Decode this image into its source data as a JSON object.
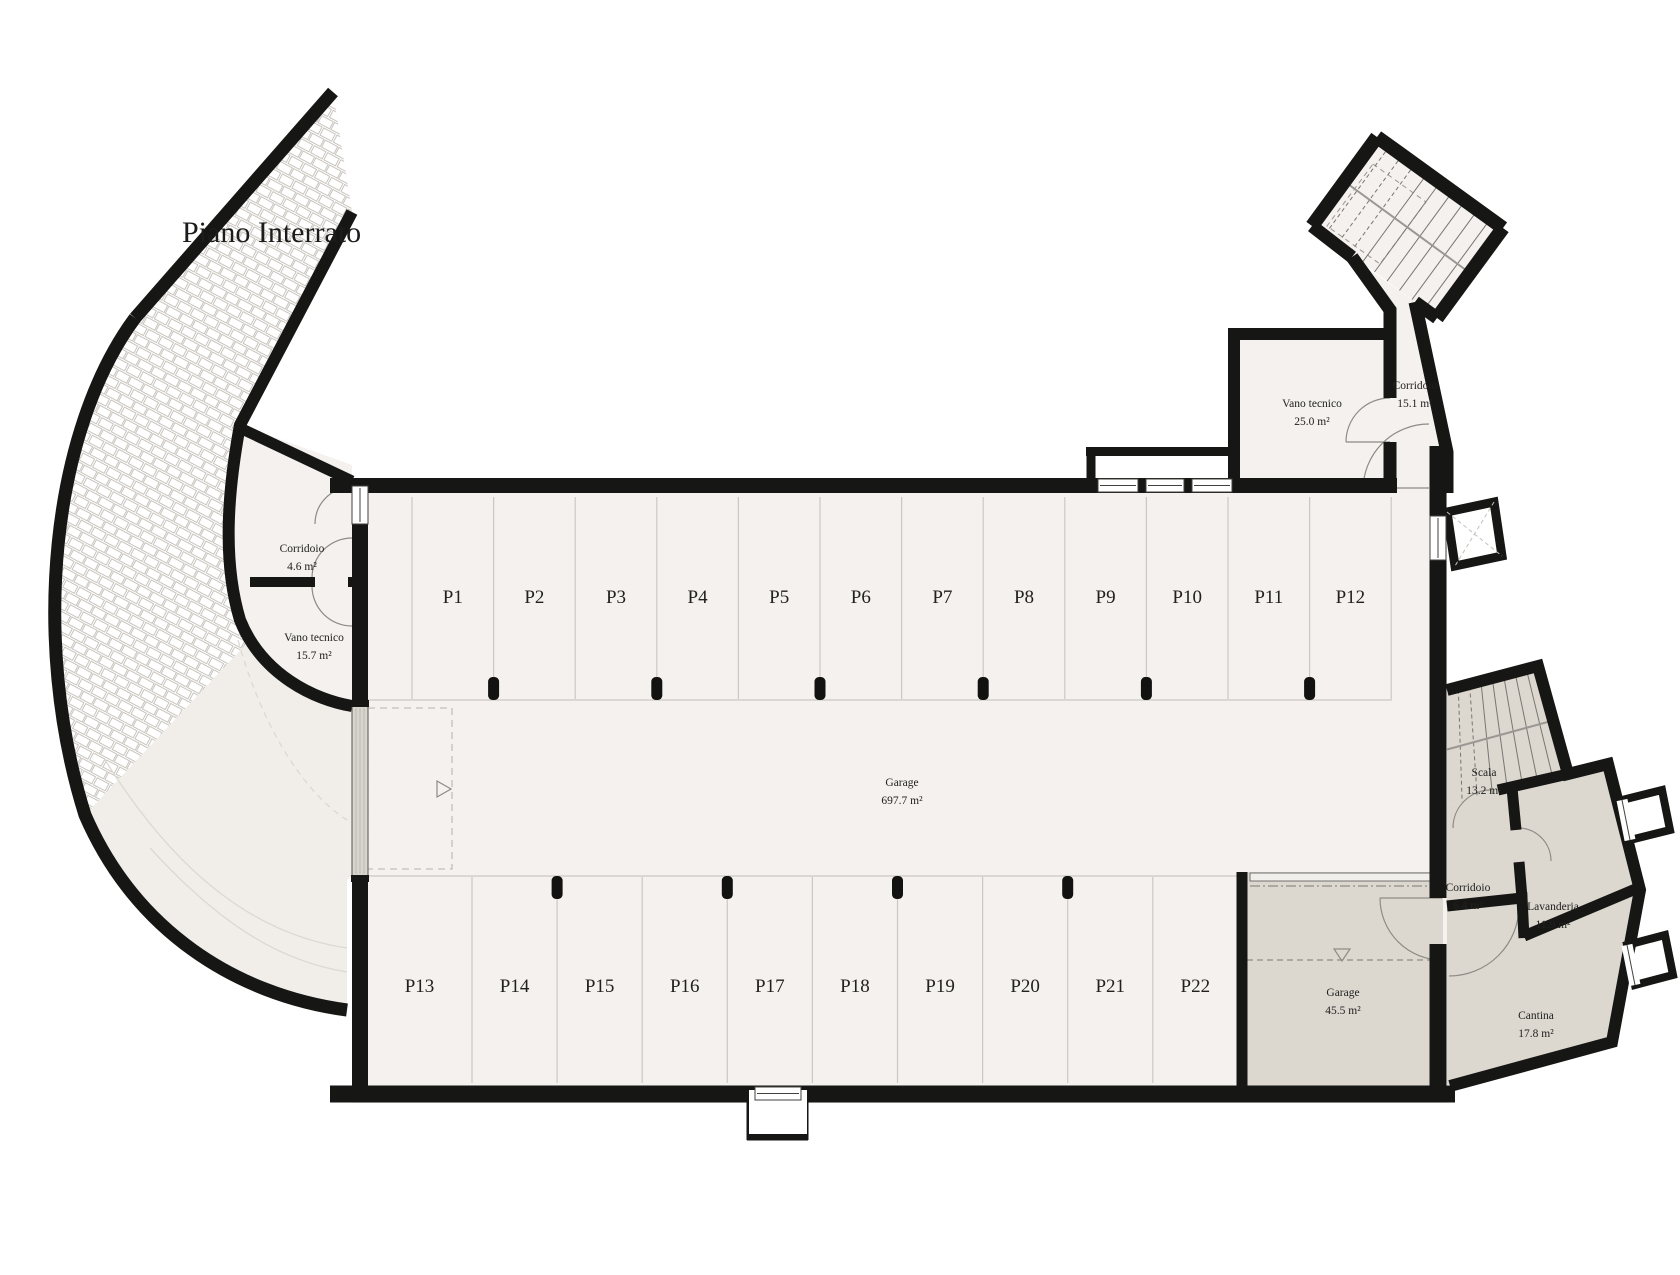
{
  "title": "Piano Interrato",
  "floor_plan": {
    "rooms": [
      {
        "id": "corridoio-ovest",
        "name": "Corridoio",
        "area": "4.6 m²"
      },
      {
        "id": "vano-tecnico-ovest",
        "name": "Vano tecnico",
        "area": "15.7 m²"
      },
      {
        "id": "garage-principale",
        "name": "Garage",
        "area": "697.7 m²"
      },
      {
        "id": "vano-tecnico-nord",
        "name": "Vano tecnico",
        "area": "25.0 m²"
      },
      {
        "id": "corridoio-nord",
        "name": "Corridoio",
        "area": "15.1 m²"
      },
      {
        "id": "scala",
        "name": "Scala",
        "area": "13.2 m²"
      },
      {
        "id": "corridoio-est",
        "name": "Corridoio",
        "area": "6.4 m²"
      },
      {
        "id": "lavanderia",
        "name": "Lavanderia",
        "area": "11.9 m²"
      },
      {
        "id": "cantina",
        "name": "Cantina",
        "area": "17.8 m²"
      },
      {
        "id": "garage-privato",
        "name": "Garage",
        "area": "45.5 m²"
      }
    ],
    "parking": {
      "top_row": [
        "P1",
        "P2",
        "P3",
        "P4",
        "P5",
        "P6",
        "P7",
        "P8",
        "P9",
        "P10",
        "P11",
        "P12"
      ],
      "bottom_row": [
        "P13",
        "P14",
        "P15",
        "P16",
        "P17",
        "P18",
        "P19",
        "P20",
        "P21",
        "P22"
      ]
    },
    "markers": {
      "door_swing_direction": "▷",
      "slope_direction": "▽"
    },
    "colors": {
      "wall": "#161614",
      "floor": "#f4f1ee",
      "ramp_floor": "#f1eeea",
      "service_room": "#dcd8d0",
      "hatch_line": "#c8c4be",
      "thin_line": "#ccc8c1",
      "text": "#21211f"
    }
  }
}
